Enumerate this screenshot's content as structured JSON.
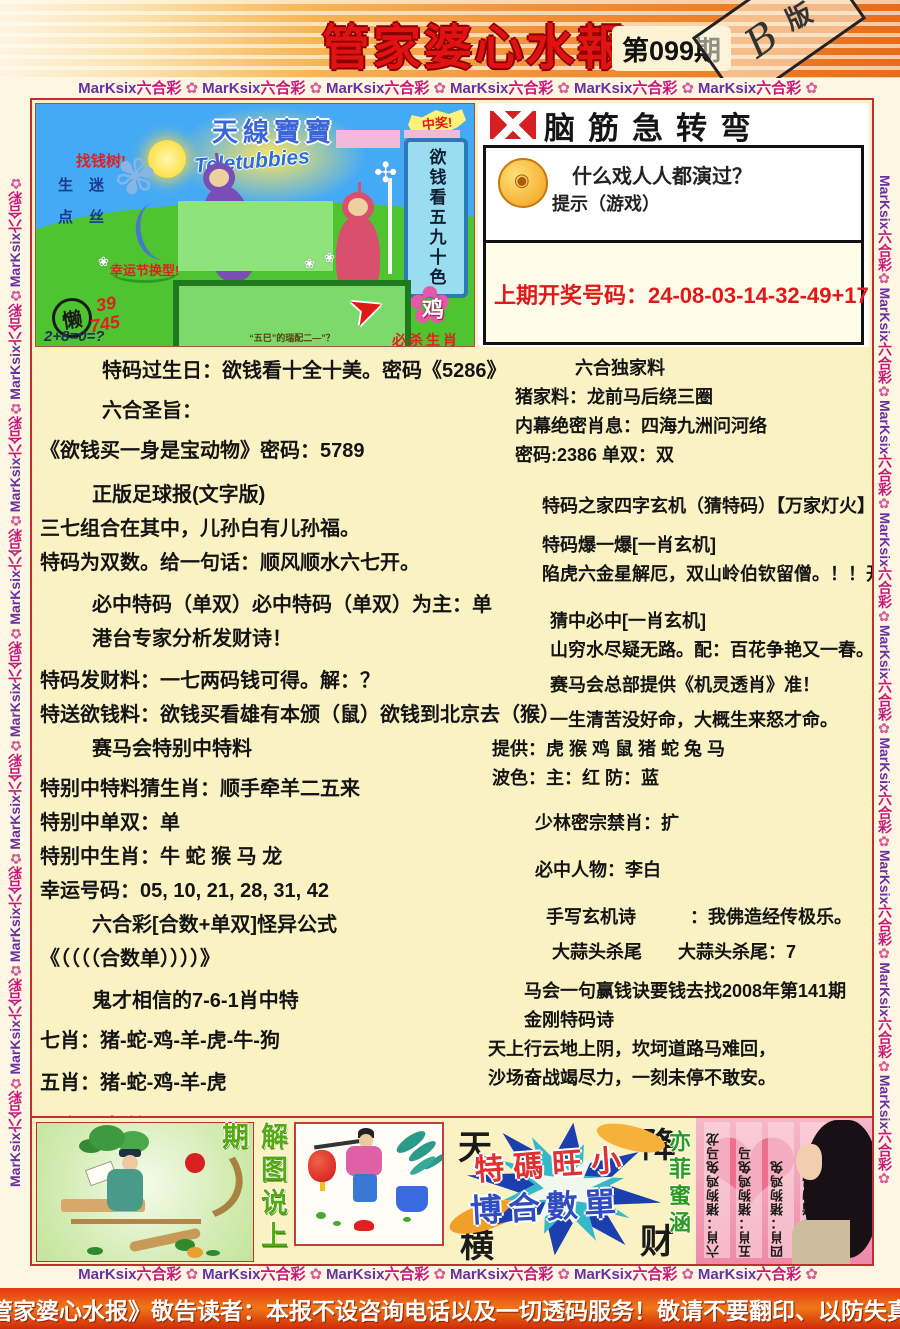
{
  "header": {
    "title": "管家婆心水報",
    "issue": "第099期",
    "stamp_letter": "B",
    "stamp_char": "版"
  },
  "border": {
    "latin": "MarKsix",
    "cjk": "六合彩",
    "flower": "✿"
  },
  "colors": {
    "title_red": "#e01212",
    "border_purple": "#6a2fa0",
    "border_magenta": "#c8187c",
    "frame_red": "#c03030",
    "paper_cream": "#fbf2c4",
    "draw_red": "#e01818"
  },
  "cartoon": {
    "title": "天線寶寶",
    "title_en": "Teletubbies",
    "money_tree": "找钱树!",
    "tree_chars": "生迷点丝",
    "win_badge": "中奖!",
    "scroll_text": "欲钱看五九十色",
    "tip_label": "幸运节换型!",
    "board_text": "“五巳”的瑞配二—”？",
    "lazy_char": "懒",
    "red_num1": "39",
    "red_num2": "745",
    "equation": "2+8=0=?",
    "arrow_icon": "➤",
    "flower_icon": "✿",
    "daisy_icon": "❀",
    "pinwheel_icon": "✣",
    "blueflower_icon": "✾",
    "zodiac_char": "鸡",
    "kill_label": "必杀生肖"
  },
  "teaser": {
    "header": "脑筋急转弯",
    "question": "什么戏人人都演过？",
    "hint": "提示（游戏）",
    "last_draw": "上期开奖号码：24-08-03-14-32-49+17"
  },
  "main": {
    "left_lines": [
      {
        "t": "特码过生日：欲钱看十全十美。密码《5286》",
        "ml": 62
      },
      {
        "t": "六合圣旨：",
        "ml": 62,
        "mt": 6
      },
      {
        "t": "《欲钱买一身是宝动物》密码：5789",
        "ml": 0,
        "mt": 6
      },
      {
        "t": "正版足球报(文字版)",
        "ml": 52,
        "mt": 10
      },
      {
        "t": "三七组合在其中，儿孙白有儿孙福。",
        "ml": 0
      },
      {
        "t": "特码为双数。给一句话：顺风顺水六七开。",
        "ml": 0
      },
      {
        "t": "必中特码（单双）必中特码（单双）为主：单",
        "ml": 52,
        "mt": 8
      },
      {
        "t": "港台专家分析发财诗！",
        "ml": 52
      },
      {
        "t": "特码发财料：一七两码钱可得。解：？",
        "ml": 0,
        "mt": 8
      },
      {
        "t": "特送欲钱料：欲钱买看雄有本颁（鼠）欲钱到北京去（猴）",
        "ml": 0
      },
      {
        "t": "赛马会特别中特料",
        "ml": 52
      },
      {
        "t": "特别中特料猜生肖：顺手牵羊二五来",
        "ml": 0,
        "mt": 6
      },
      {
        "t": "特别中单双：单",
        "ml": 0
      },
      {
        "t": "特别中生肖：牛 蛇 猴 马 龙",
        "ml": 0
      },
      {
        "t": "幸运号码：05, 10, 21, 28, 31, 42",
        "ml": 0
      },
      {
        "t": "六合彩[合数+单双]怪异公式",
        "ml": 52
      },
      {
        "t": "《（（（（合数单））））》",
        "ml": 0
      },
      {
        "t": "鬼才相信的7-6-1肖中特",
        "ml": 52,
        "mt": 8
      },
      {
        "t": "七肖：猪-蛇-鸡-羊-虎-牛-狗",
        "ml": 0,
        "mt": 6
      },
      {
        "t": "五肖：猪-蛇-鸡-羊-虎",
        "ml": 0,
        "mt": 8
      },
      {
        "t": "二肖：猪-蛇",
        "ml": 0,
        "mt": 10
      }
    ],
    "right_lines": [
      {
        "t": "六合独家料",
        "ml": 95
      },
      {
        "t": "猪家料：龙前马后绕三圈",
        "ml": 35
      },
      {
        "t": "内幕绝密肖息：四海九洲问河络",
        "ml": 35
      },
      {
        "t": "密码:2386 单双：双",
        "ml": 35
      },
      {
        "t": "特码之家四字玄机（猜特码）【万家灯火】",
        "ml": 62,
        "mt": 22
      },
      {
        "t": "特码爆一爆[一肖玄机]",
        "ml": 62,
        "mt": 10
      },
      {
        "t": "陷虎六金星解厄，双山岭伯钦留僧。！！开（？？）",
        "ml": 62
      },
      {
        "t": "猜中必中[一肖玄机]",
        "ml": 70,
        "mt": 18
      },
      {
        "t": "山穷水尽疑无路。配：百花争艳又一春。",
        "ml": 70
      },
      {
        "t": "赛马会总部提供《机灵透肖》准！",
        "ml": 70,
        "mt": 6
      },
      {
        "t": "一生清苦没好命，大概生来怒才命。",
        "ml": 70,
        "mt": 6
      },
      {
        "t": "提供：虎 猴 鸡 鼠 猪 蛇 兔 马",
        "ml": 12
      },
      {
        "t": "波色：主：红 防：蓝",
        "ml": 12
      },
      {
        "t": "少林密宗禁肖：扩",
        "ml": 55,
        "mt": 16
      },
      {
        "t": "必中人物：李白",
        "ml": 55,
        "mt": 18
      },
      {
        "t": "手写玄机诗　　　：我佛造经传极乐。",
        "ml": 66,
        "mt": 18
      },
      {
        "t": "大蒜头杀尾　　大蒜头杀尾：7",
        "ml": 72,
        "mt": 6
      },
      {
        "t": "马会一句赢钱诀要钱去找2008年第141期",
        "ml": 44,
        "mt": 10
      },
      {
        "t": "金刚特码诗",
        "ml": 44
      },
      {
        "t": "天上行云地上阴，坎坷道路马难回，",
        "ml": 8
      },
      {
        "t": "沙场奋战竭尽力，一刻未停不敢安。",
        "ml": 8
      }
    ]
  },
  "bottom": {
    "explain_vertical": "解图说上期",
    "corner_tl": "天",
    "corner_tr": "降",
    "corner_bl": "横",
    "corner_br": "财",
    "burst_line1": "特碼旺小",
    "burst_line2": "博合數單",
    "green_vertical": "亦菲蜜涵",
    "heart_icon": "❤",
    "pink_columns": [
      "六肖：猪狗鸡兔马龙",
      "五肖：猪狗鸡兔马",
      "四肖：猪狗鸡兔",
      "三肖：猪狗鸡"
    ]
  },
  "footer": {
    "notice": "《管家婆心水报》敬告读者：本报不设咨询电话以及一切透码服务！敬请不要翻印、以防失真！"
  }
}
